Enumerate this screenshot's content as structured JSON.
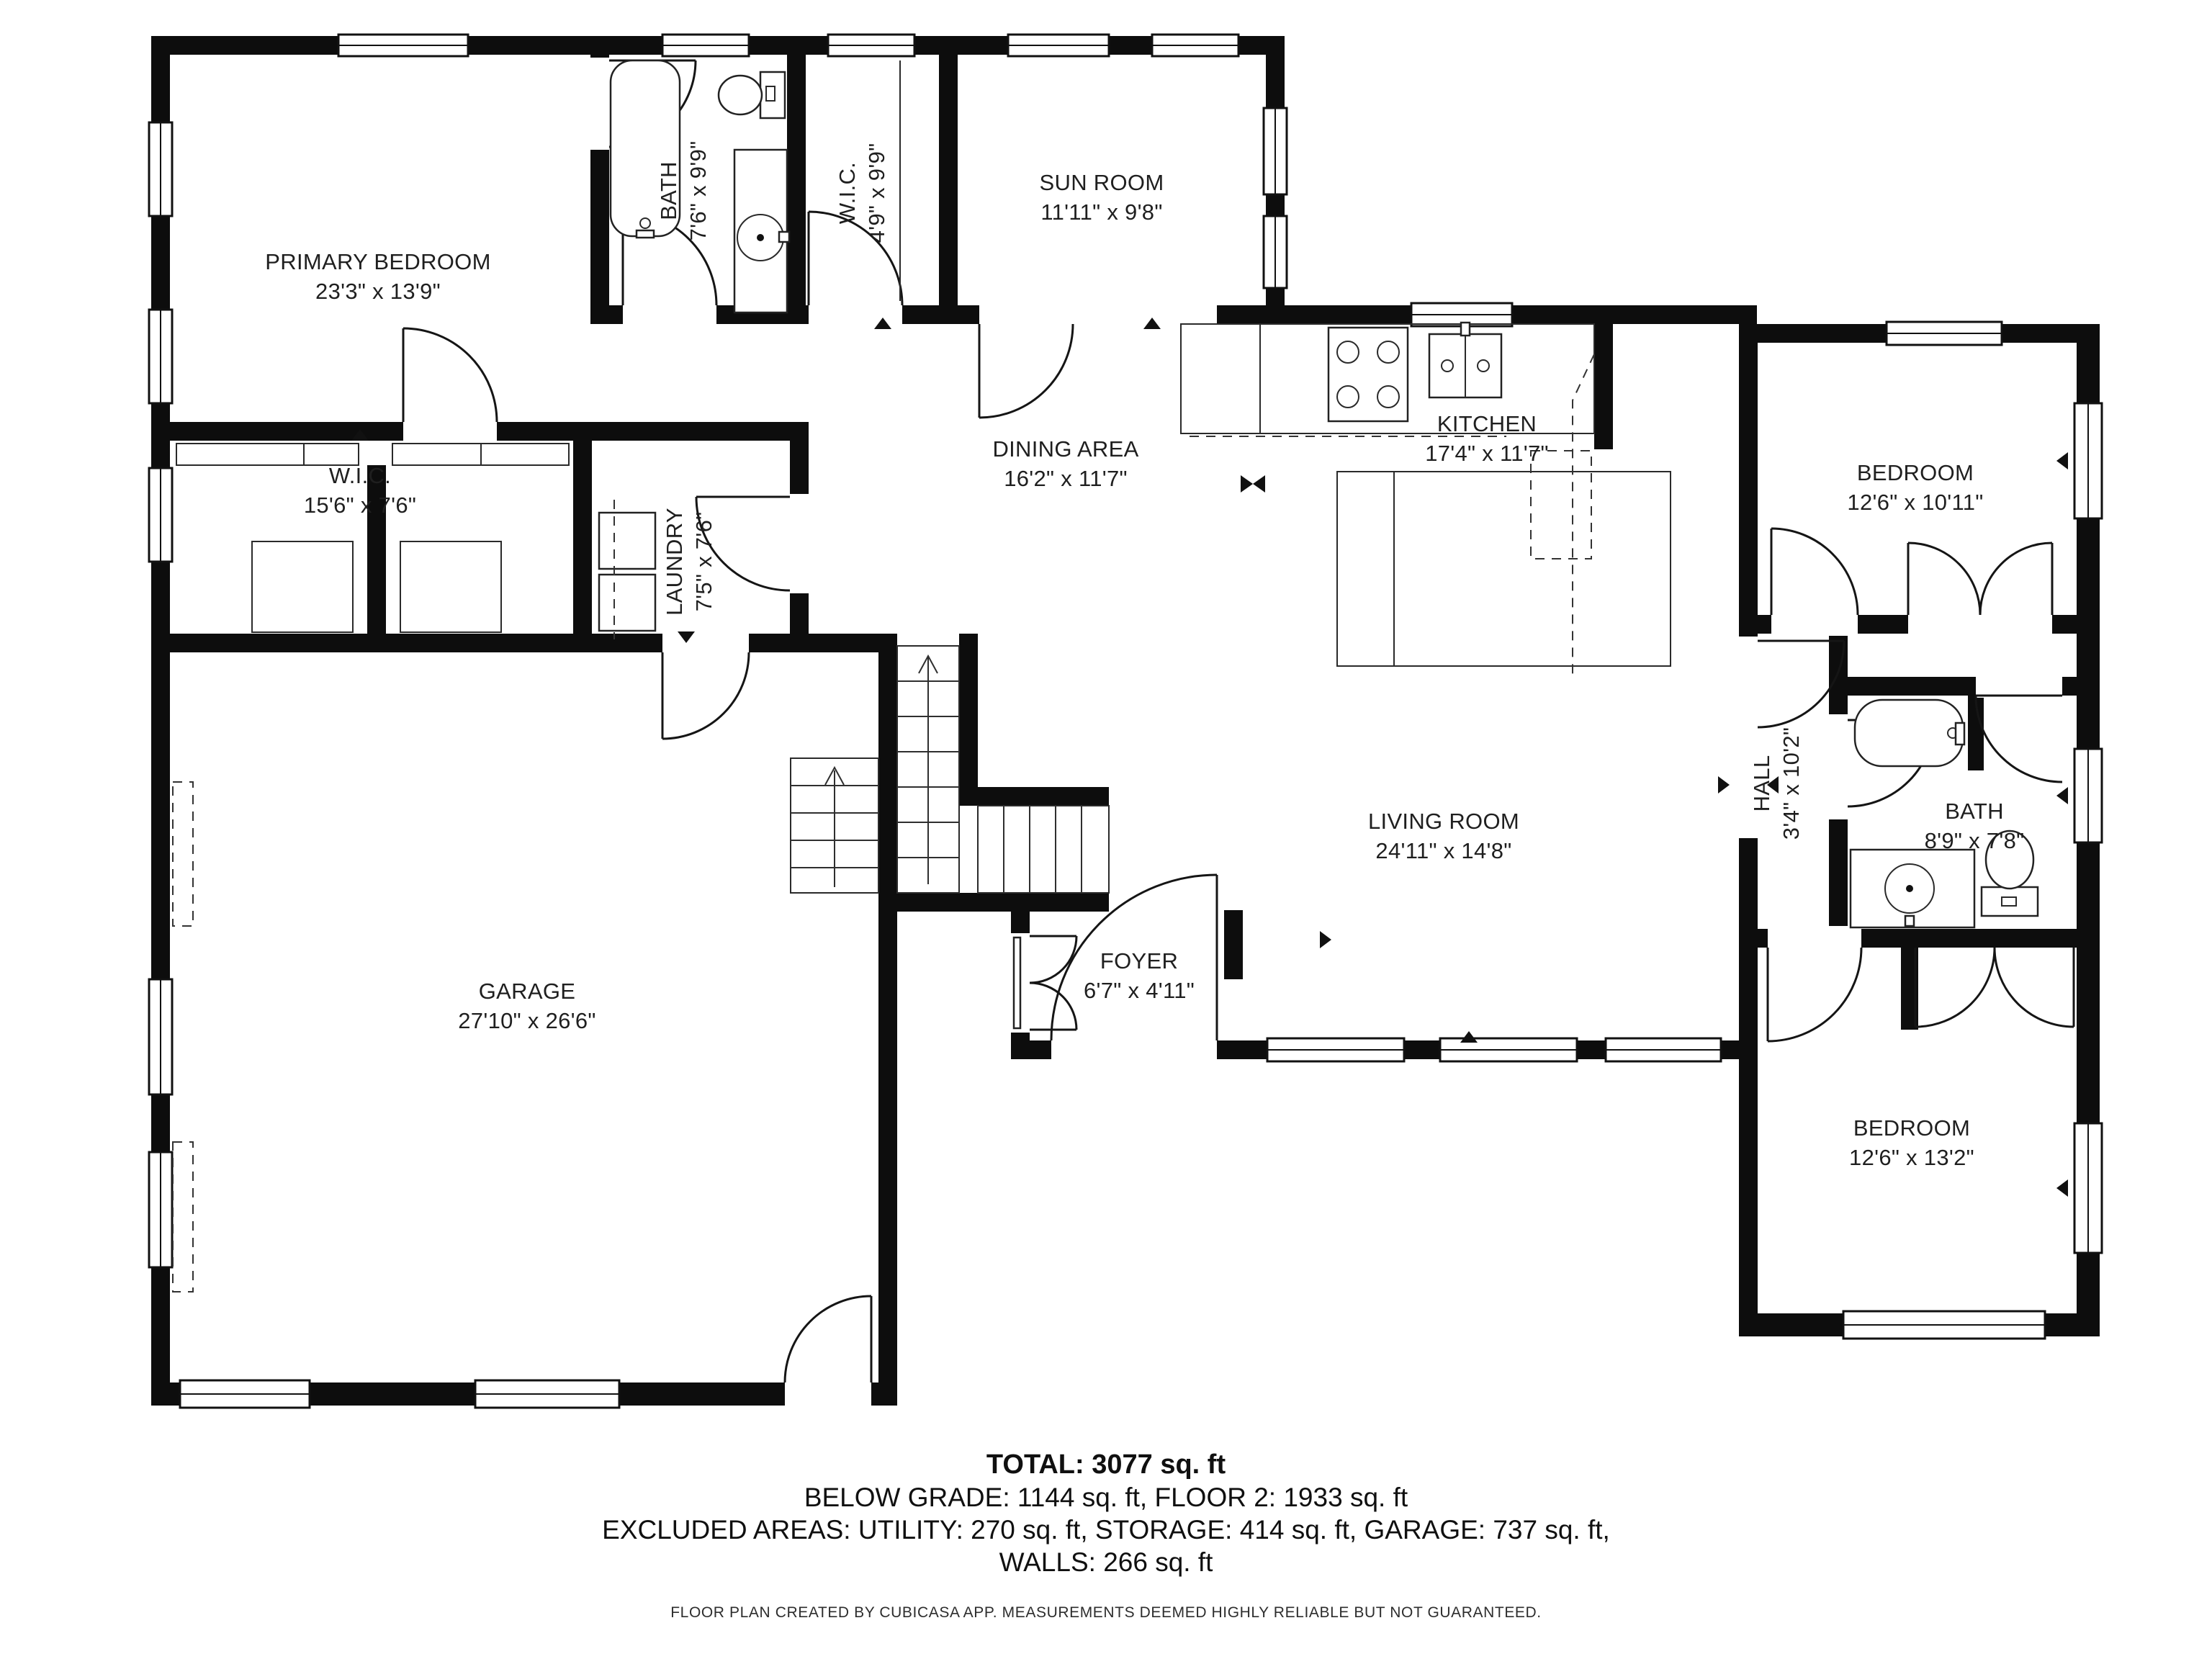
{
  "document": {
    "type": "floor-plan",
    "creator_note": "FLOOR PLAN CREATED BY CUBICASA APP. MEASUREMENTS DEEMED HIGHLY RELIABLE BUT NOT GUARANTEED."
  },
  "rooms": [
    {
      "id": "primary-bedroom",
      "name": "PRIMARY BEDROOM",
      "dims": "23'3\" x 13'9\""
    },
    {
      "id": "bath-upper",
      "name": "BATH",
      "dims": "7'6\" x 9'9\""
    },
    {
      "id": "wic-upper",
      "name": "W.I.C.",
      "dims": "4'9\" x 9'9\""
    },
    {
      "id": "sun-room",
      "name": "SUN ROOM",
      "dims": "11'11\" x 9'8\""
    },
    {
      "id": "dining-area",
      "name": "DINING AREA",
      "dims": "16'2\" x 11'7\""
    },
    {
      "id": "kitchen",
      "name": "KITCHEN",
      "dims": "17'4\" x 11'7\""
    },
    {
      "id": "bedroom-upper-right",
      "name": "BEDROOM",
      "dims": "12'6\" x 10'11\""
    },
    {
      "id": "wic-left",
      "name": "W.I.C.",
      "dims": "15'6\" x 7'6\""
    },
    {
      "id": "laundry",
      "name": "LAUNDRY",
      "dims": "7'5\" x 7'6\""
    },
    {
      "id": "hall",
      "name": "HALL",
      "dims": "3'4\" x 10'2\""
    },
    {
      "id": "bath-right",
      "name": "BATH",
      "dims": "8'9\" x 7'8\""
    },
    {
      "id": "living-room",
      "name": "LIVING ROOM",
      "dims": "24'11\" x 14'8\""
    },
    {
      "id": "foyer",
      "name": "FOYER",
      "dims": "6'7\" x 4'11\""
    },
    {
      "id": "garage",
      "name": "GARAGE",
      "dims": "27'10\" x 26'6\""
    },
    {
      "id": "bedroom-lower-right",
      "name": "BEDROOM",
      "dims": "12'6\" x 13'2\""
    }
  ],
  "summary": {
    "total": "TOTAL: 3077 sq. ft",
    "line2": "BELOW GRADE: 1144 sq. ft, FLOOR 2: 1933 sq. ft",
    "line3": "EXCLUDED AREAS: UTILITY: 270 sq. ft, STORAGE: 414 sq. ft, GARAGE: 737 sq. ft,",
    "line4": "WALLS: 266 sq. ft"
  },
  "colors": {
    "wall": "#0d0d0d",
    "background": "#ffffff",
    "text": "#1f1f1f"
  }
}
